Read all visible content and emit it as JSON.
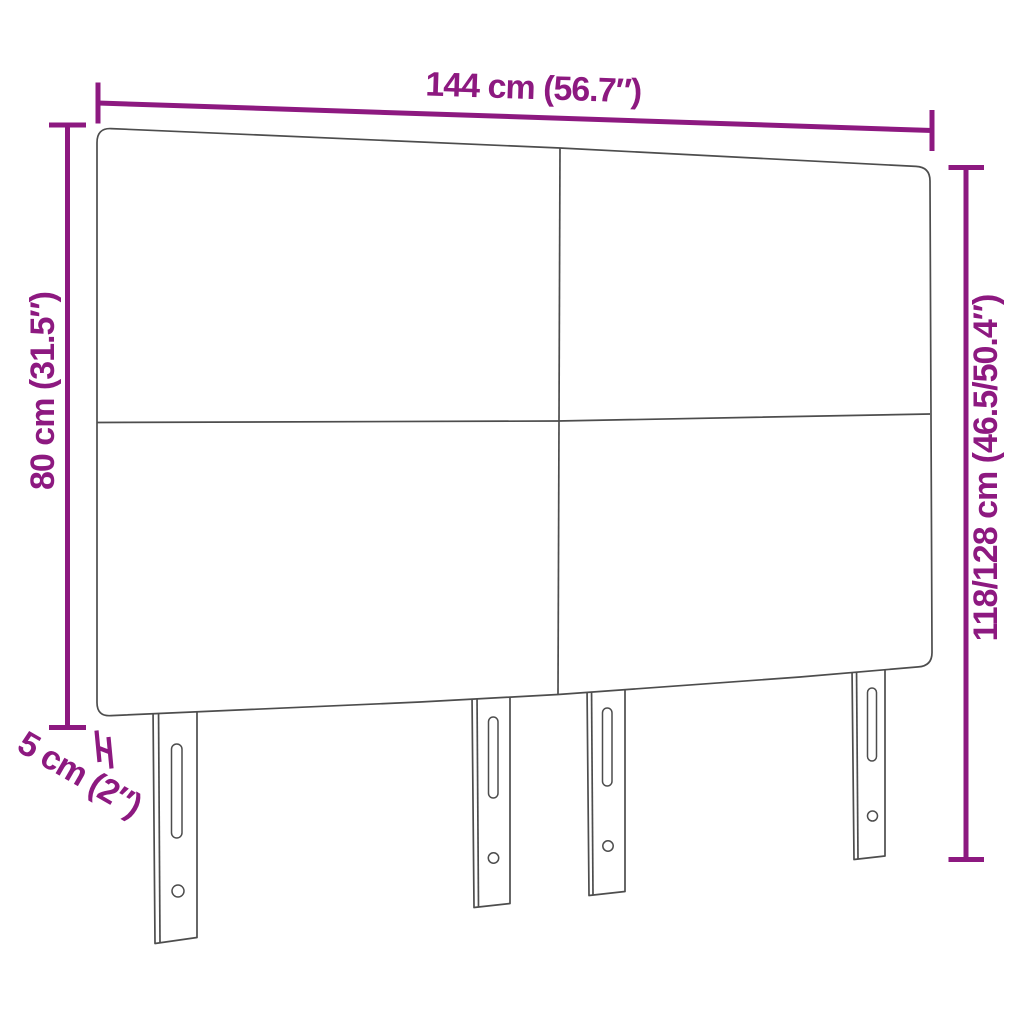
{
  "diagram": {
    "figure": "headboard-with-four-legs",
    "dimensions": {
      "width": {
        "label": "144 cm (56.7″)"
      },
      "panel_height": {
        "label": "80 cm (31.5″)"
      },
      "total_height": {
        "label": "118/128 cm (46.5/50.4″)"
      },
      "depth": {
        "label": "5 cm (2″)"
      }
    },
    "colors": {
      "dimension": "#8D1980",
      "outline": "#4D4D4D",
      "background": "#FFFFFF"
    }
  }
}
